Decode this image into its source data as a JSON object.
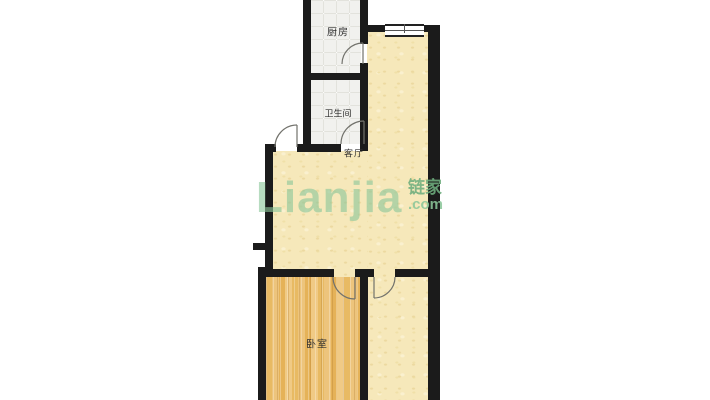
{
  "page": {
    "background": "#ffffff"
  },
  "floorplan": {
    "rooms": [
      {
        "id": "kitchen",
        "label": "厨房"
      },
      {
        "id": "bathroom",
        "label": "卫生间"
      },
      {
        "id": "living_room",
        "label": "客厅"
      },
      {
        "id": "bedroom",
        "label": "卧室"
      }
    ],
    "watermark": {
      "brand": "Lianjia",
      "brand_cn": "链家",
      "domain": ".com"
    },
    "colors": {
      "page_bg": "#ffffff",
      "wall": "#1b1b1b",
      "floor_yellow": "#f6e8ba",
      "floor_tile": "#f1f1ee",
      "floor_wood": "#eabf70",
      "door_line": "#72726c",
      "watermark_green": "#8cc79a"
    },
    "features": {
      "doors": [
        "entry-door",
        "kitchen-door",
        "bathroom-door",
        "bedroom-door",
        "second-room-door"
      ],
      "windows": [
        "living-room-window"
      ]
    }
  }
}
